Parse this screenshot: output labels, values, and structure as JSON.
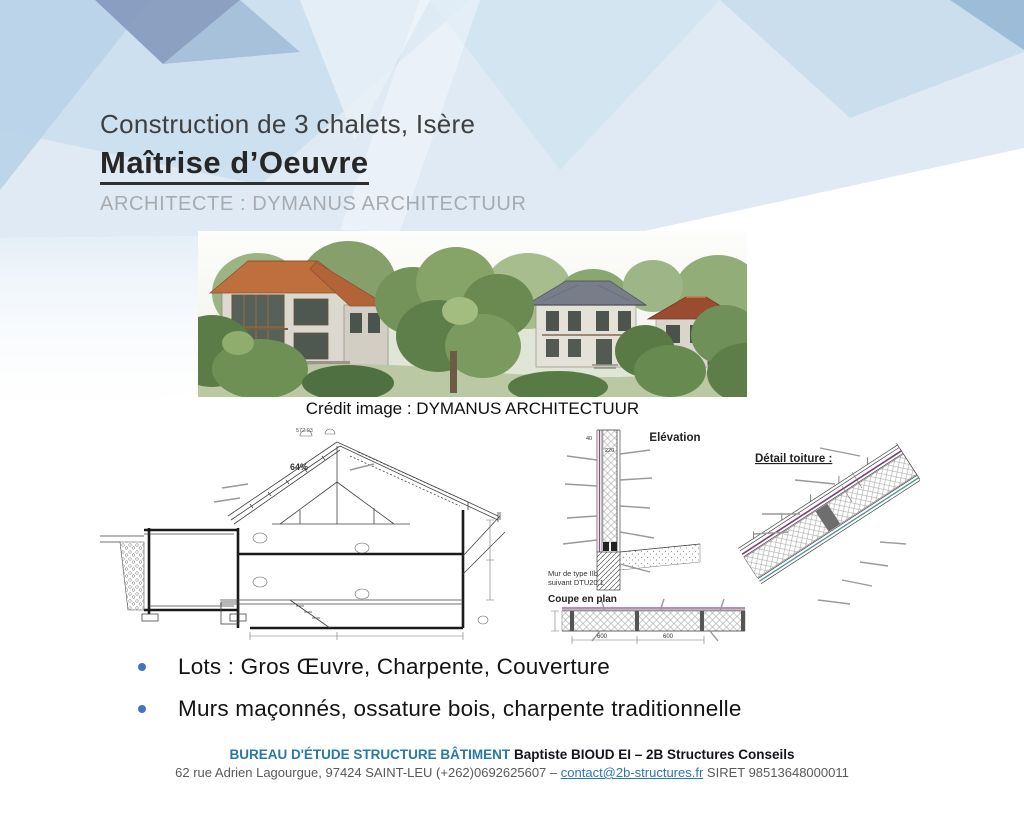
{
  "slide": {
    "header": {
      "title": "Construction de 3 chalets, Isère",
      "subtitle": "Maîtrise d’Oeuvre",
      "architect": "ARCHITECTE : DYMANUS ARCHITECTUUR"
    },
    "hero": {
      "caption": "Crédit image : DYMANUS ARCHITECTUUR"
    },
    "drawings": {
      "section": {
        "slope": "64%",
        "ridge_elevation": "572.93"
      },
      "elevation": {
        "title": "Elévation",
        "dim_top": "40",
        "dim_wall": "220",
        "wall_note_line1": "Mur de type IIb",
        "wall_note_line2": "suivant DTU20.1"
      },
      "plan": {
        "title": "Coupe en plan",
        "dim_left": "600",
        "dim_right": "600"
      },
      "roof": {
        "title": "Détail toiture :"
      }
    },
    "bullets": [
      "Lots : Gros Œuvre, Charpente, Couverture",
      "Murs maçonnés, ossature bois, charpente traditionnelle"
    ],
    "footer": {
      "org": "BUREAU D'ÉTUDE STRUCTURE BÂTIMENT",
      "company": "Baptiste BIOUD EI – 2B Structures Conseils",
      "address": "62 rue Adrien Lagourgue, 97424 SAINT-LEU (+262)0692625607 –",
      "email": "contact@2b-structures.fr",
      "siret": "SIRET 98513648000011"
    },
    "colors": {
      "accent_bullet": "#4472c4",
      "footer_org_blue": "#2878a8",
      "link_blue": "#2e75b6",
      "title_dark": "#3f4040",
      "architect_gray": "#a7abb0"
    }
  }
}
